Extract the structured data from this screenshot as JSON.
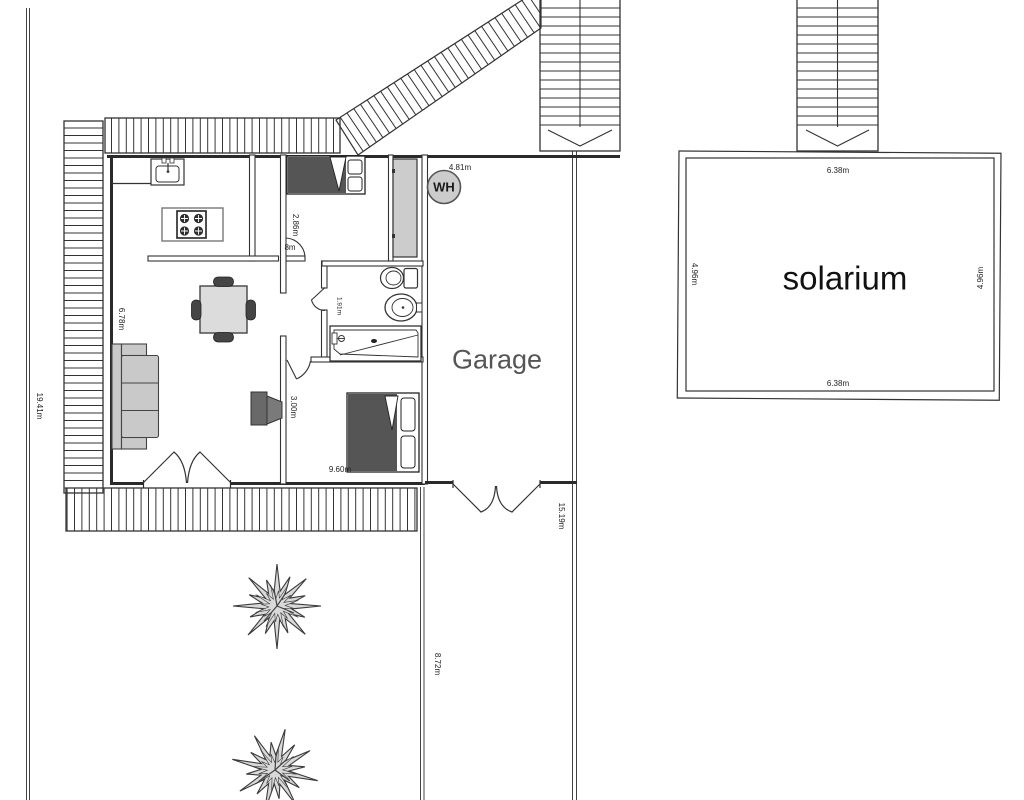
{
  "labels": {
    "garage": "Garage",
    "solarium": "solarium",
    "water_heater": "WH"
  },
  "dimensions": {
    "boundary_left": "19.41m",
    "living_height": "6.78m",
    "bedroom1_height": "2.86m",
    "bedroom1_door": "8m",
    "bathroom_door": "1.91m",
    "bedroom2_height": "3.00m",
    "house_width": "9.60m",
    "garage_top": "4.81m",
    "garage_right": "15.19m",
    "driveway": "8.72m",
    "solarium_top": "6.38m",
    "solarium_bottom": "6.38m",
    "solarium_left": "4.96m",
    "solarium_right": "4.96m"
  },
  "colors": {
    "wall": "#333333",
    "line": "#444444",
    "furniture_light": "#cccccc",
    "furniture_mid": "#c9c9c9",
    "furniture_dark": "#555555",
    "tree_fill": "#d9d9d9",
    "room_label": "#555555",
    "text": "#222222",
    "background": "#ffffff"
  }
}
